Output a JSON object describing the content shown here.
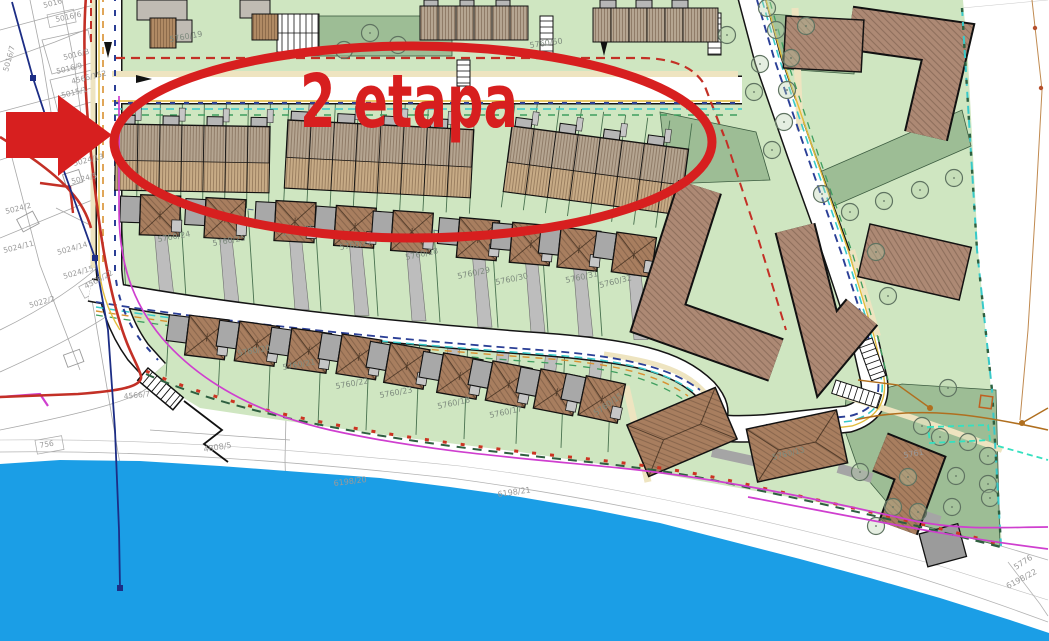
{
  "annotation": {
    "text": "2 etapa"
  },
  "colors": {
    "water": "#1b9ee6",
    "green_light": "#cfe6c1",
    "green_dark": "#9dbd95",
    "roof_tan": "#c7ab86",
    "roof_top": "#b5a591",
    "roof_gray": "#b6b6b6",
    "apartment_brown": "#ad8974",
    "house_roof": "#a87e5f",
    "garage_gray": "#a8a8a8",
    "driveway_gray": "#bdbdbd",
    "annotation_red": "#d71f1f",
    "magenta": "#cf3fcf",
    "red_boundary": "#c33026",
    "cadastral_blue": "#1c2d85",
    "teal": "#38c9c9",
    "dash_blue": "#2b3f96",
    "dash_green": "#3f9e5f",
    "dash_orange": "#d89030",
    "yellow": "#e2bc3c",
    "cream": "#eee4c0",
    "boundary_green": "#2f5f40",
    "utility_brown": "#b06f1f"
  },
  "labels": {
    "cadastral": [
      "5016",
      "5016/6",
      "5016/8",
      "5016/9",
      "4566/152",
      "5015/1",
      "5016/7",
      "5024/13",
      "5024/5",
      "5024/2",
      "5024/11",
      "5024/14",
      "5024/15",
      "4566/22",
      "5022/2",
      "756",
      "4566/7"
    ],
    "parcels": [
      "5760/19",
      "5760/50",
      "5760/24",
      "5760/25",
      "5760/26",
      "5760/27",
      "5760/28",
      "5760/29",
      "5760/30",
      "5760/31",
      "5760/32",
      "5760/20",
      "5760/21",
      "5760/22",
      "5760/23",
      "5760/18",
      "5760/17",
      "5760/15",
      "5760/13"
    ],
    "shore": [
      "4808/5",
      "6198/20",
      "6198/21",
      "6198/22",
      "5776",
      "5761"
    ]
  }
}
